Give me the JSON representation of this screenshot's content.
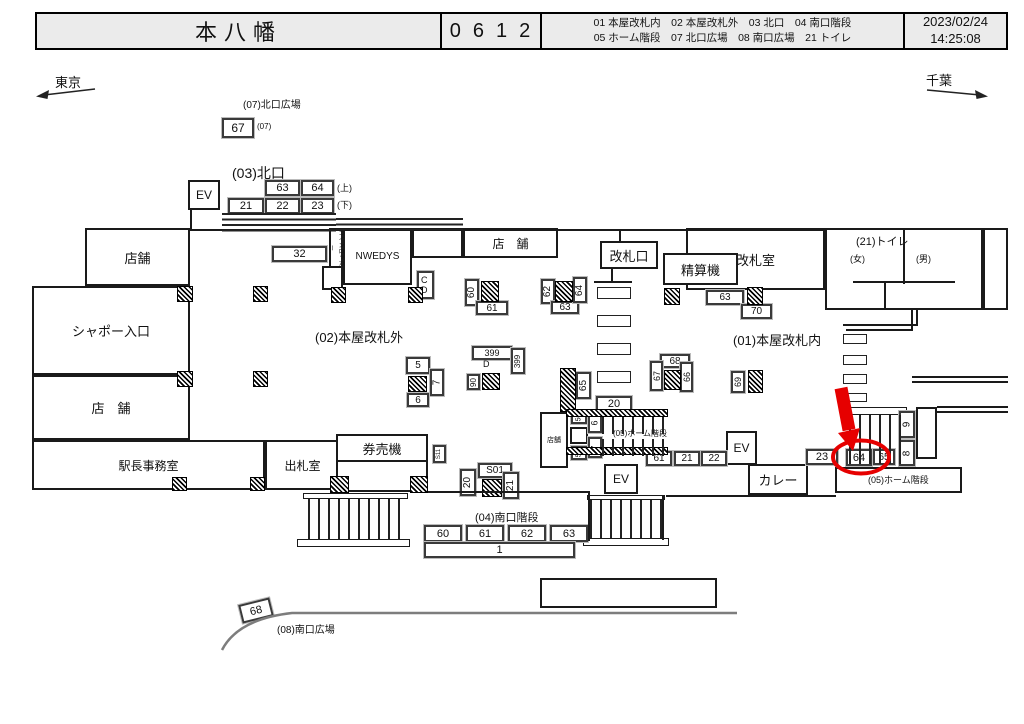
{
  "header": {
    "station": "本八幡",
    "code": "0612",
    "legend_line1": "01 本屋改札内　02 本屋改札外　03 北口　04 南口階段",
    "legend_line2": "05 ホーム階段　07 北口広場　08 南口広場　21 トイレ",
    "date": "2023/02/24",
    "time": "14:25:08"
  },
  "directions": {
    "left": "東京",
    "right": "千葉"
  },
  "highlight": {
    "circled_position": "64",
    "color": "#e60000"
  },
  "labels": {
    "ev_north": "EV",
    "b67": "67",
    "l07kita": "(07)北口広場",
    "s07": "(07)",
    "l03kita": "(03)北口",
    "b63n": "63",
    "b64n": "64",
    "b21n": "21",
    "b22n": "22",
    "b23n": "23",
    "lue": "(上)",
    "lshita": "(下)",
    "shop1": "店舗",
    "chapeau": "シャポー入口",
    "shop2": "店　舗",
    "stationmaster": "駅長事務室",
    "shussatsu": "出札室",
    "kenbaiki": "券売機",
    "b32": "32",
    "coinlocker": "コインロッカー",
    "nwedys": "NWEDYS",
    "shopN": "店　舗",
    "cd": "C D",
    "kaisatsuguchi": "改札口",
    "seisanki": "精算機",
    "kaisatsushitsu": "改札室",
    "toilet": "(21)トイレ",
    "female": "(女)",
    "male": "(男)",
    "l02": "(02)本屋改札外",
    "l01": "(01)本屋改札内",
    "b60v": "60",
    "b61g": "61",
    "b62v": "62",
    "b63g": "63",
    "b64v": "64",
    "b63r": "63",
    "b70": "70",
    "b5": "5",
    "b6": "6",
    "b7v": "7",
    "b399": "399",
    "bD": "D",
    "b399v": "399",
    "b90v": "90",
    "b65v": "65",
    "b68c": "68",
    "b67v": "67",
    "b66v": "66",
    "b69v": "69",
    "b20": "20",
    "shop3": "店舗",
    "b50a": "50",
    "b6v": "6",
    "b7v2": "7",
    "b50b": "50",
    "l05a": "(05)ホーム階段",
    "b61s": "61",
    "b21s": "21",
    "b22s": "22",
    "ev1": "EV",
    "ev2": "EV",
    "curry": "カレー",
    "b23s": "23",
    "b64c": "64",
    "b65s": "65",
    "b9v": "9",
    "b8v": "8",
    "l05box": "(05)ホーム階段",
    "s01": "S01",
    "b20v": "20",
    "b21v": "21",
    "s11": "S11",
    "l04": "(04)南口階段",
    "b60s": "60",
    "b61t": "61",
    "b62s": "62",
    "b63t": "63",
    "b1": "1",
    "b68t": "68",
    "l08": "(08)南口広場"
  }
}
